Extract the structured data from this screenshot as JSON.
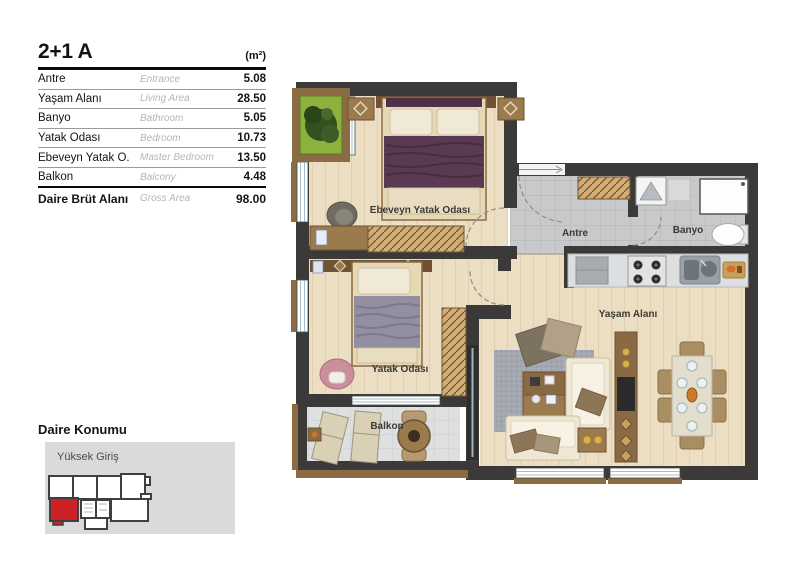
{
  "table": {
    "title": "2+1 A",
    "unit": "(m²)",
    "rows": [
      {
        "tr": "Antre",
        "en": "Entrance",
        "val": "5.08"
      },
      {
        "tr": "Yaşam Alanı",
        "en": "Living Area",
        "val": "28.50"
      },
      {
        "tr": "Banyo",
        "en": "Bathroom",
        "val": "5.05"
      },
      {
        "tr": "Yatak Odası",
        "en": "Bedroom",
        "val": "10.73"
      },
      {
        "tr": "Ebeveyn Yatak O.",
        "en": "Master Bedroom",
        "val": "13.50"
      },
      {
        "tr": "Balkon",
        "en": "Balcony",
        "val": "4.48"
      }
    ],
    "total": {
      "tr": "Daire Brüt Alanı",
      "en": "Gross Area",
      "val": "98.00"
    }
  },
  "plan": {
    "labels": {
      "master_bedroom": "Ebeveyn Yatak Odası",
      "entrance": "Antre",
      "bathroom": "Banyo",
      "living_area": "Yaşam Alanı",
      "bedroom": "Yatak Odası",
      "balcony": "Balkon"
    }
  },
  "location": {
    "title": "Daire Konumu",
    "floor_label": "Yüksek Giriş"
  },
  "colors": {
    "highlight_unit": "#cd2128",
    "wall": "#3b3a38",
    "wood_floor": "#ecdec2",
    "gray_tile": "#c7c9cb",
    "balcony_tile": "#dddfe1",
    "wood_trim": "#8a6b44"
  }
}
